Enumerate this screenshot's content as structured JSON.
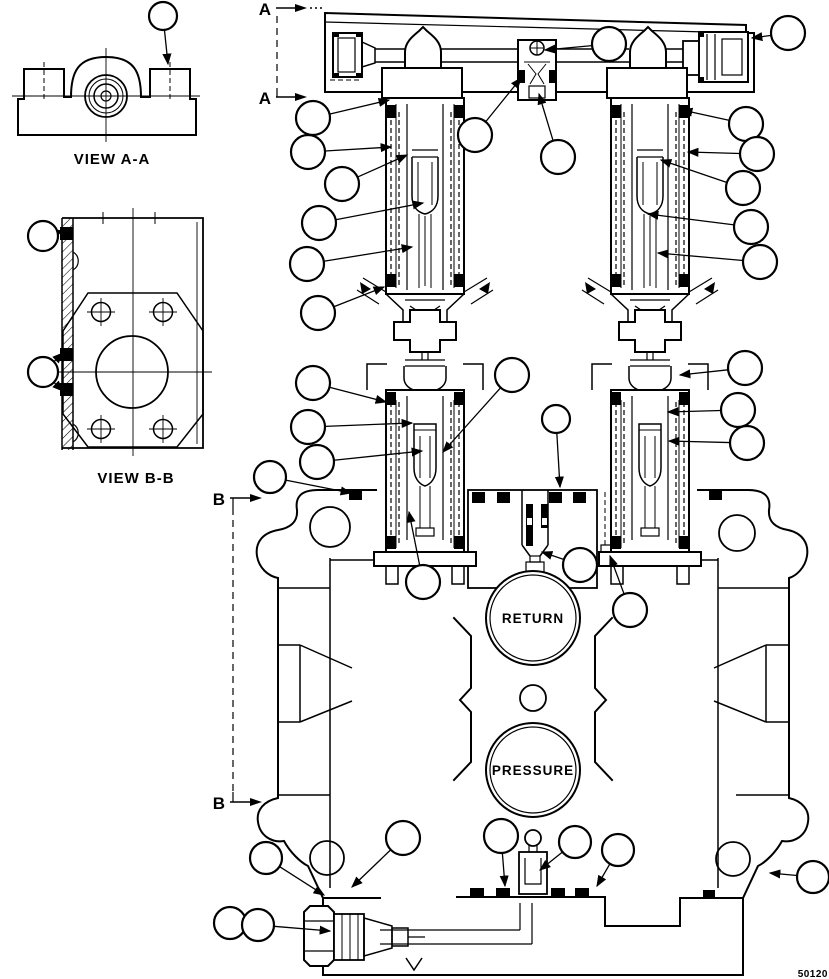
{
  "drawing": {
    "labels": {
      "view_aa": "VIEW A-A",
      "view_bb": "VIEW B-B",
      "figure_code": "50120"
    },
    "ports": {
      "return": "RETURN",
      "pressure": "PRESSURE"
    },
    "section_markers": {
      "a_top": "A",
      "a_bottom": "A",
      "b_top": "B",
      "b_bottom": "B"
    },
    "callouts": [
      {
        "x": 163,
        "y": 16,
        "r": 14,
        "to": [
          [
            168,
            64
          ]
        ]
      },
      {
        "x": 609,
        "y": 44,
        "r": 17,
        "to": [
          [
            545,
            50
          ]
        ]
      },
      {
        "x": 788,
        "y": 33,
        "r": 17,
        "to": [
          [
            752,
            38
          ]
        ]
      },
      {
        "x": 475,
        "y": 135,
        "r": 17,
        "to": [
          [
            521,
            78
          ]
        ]
      },
      {
        "x": 558,
        "y": 157,
        "r": 17,
        "to": [
          [
            539,
            94
          ]
        ]
      },
      {
        "x": 313,
        "y": 118,
        "r": 17,
        "to": [
          [
            389,
            100
          ]
        ]
      },
      {
        "x": 308,
        "y": 152,
        "r": 17,
        "to": [
          [
            391,
            147
          ]
        ]
      },
      {
        "x": 342,
        "y": 184,
        "r": 17,
        "to": [
          [
            407,
            155
          ]
        ]
      },
      {
        "x": 319,
        "y": 223,
        "r": 17,
        "to": [
          [
            423,
            203
          ]
        ]
      },
      {
        "x": 307,
        "y": 264,
        "r": 17,
        "to": [
          [
            412,
            247
          ]
        ]
      },
      {
        "x": 318,
        "y": 313,
        "r": 17,
        "to": [
          [
            384,
            287
          ]
        ]
      },
      {
        "x": 746,
        "y": 124,
        "r": 17,
        "to": [
          [
            682,
            110
          ]
        ]
      },
      {
        "x": 757,
        "y": 154,
        "r": 17,
        "to": [
          [
            688,
            152
          ]
        ]
      },
      {
        "x": 743,
        "y": 188,
        "r": 17,
        "to": [
          [
            661,
            160
          ]
        ]
      },
      {
        "x": 751,
        "y": 227,
        "r": 17,
        "to": [
          [
            648,
            214
          ]
        ]
      },
      {
        "x": 760,
        "y": 262,
        "r": 17,
        "to": [
          [
            658,
            253
          ]
        ]
      },
      {
        "x": 512,
        "y": 375,
        "r": 17,
        "to": [
          [
            443,
            452
          ]
        ]
      },
      {
        "x": 556,
        "y": 419,
        "r": 14,
        "to": [
          [
            560,
            487
          ]
        ]
      },
      {
        "x": 313,
        "y": 383,
        "r": 17,
        "to": [
          [
            386,
            402
          ]
        ]
      },
      {
        "x": 308,
        "y": 427,
        "r": 17,
        "to": [
          [
            412,
            423
          ]
        ]
      },
      {
        "x": 317,
        "y": 462,
        "r": 17,
        "to": [
          [
            422,
            451
          ]
        ]
      },
      {
        "x": 270,
        "y": 477,
        "r": 16,
        "to": [
          [
            351,
            493
          ]
        ]
      },
      {
        "x": 423,
        "y": 582,
        "r": 17,
        "to": [
          [
            409,
            512
          ]
        ]
      },
      {
        "x": 745,
        "y": 368,
        "r": 17,
        "to": [
          [
            680,
            375
          ]
        ]
      },
      {
        "x": 738,
        "y": 410,
        "r": 17,
        "to": [
          [
            668,
            412
          ]
        ]
      },
      {
        "x": 747,
        "y": 443,
        "r": 17,
        "to": [
          [
            669,
            441
          ]
        ]
      },
      {
        "x": 580,
        "y": 565,
        "r": 17,
        "to": [
          [
            542,
            552
          ]
        ]
      },
      {
        "x": 630,
        "y": 610,
        "r": 17,
        "to": [
          [
            610,
            556
          ]
        ]
      },
      {
        "x": 266,
        "y": 858,
        "r": 16,
        "to": [
          [
            324,
            895
          ]
        ]
      },
      {
        "x": 403,
        "y": 838,
        "r": 17,
        "to": [
          [
            352,
            887
          ]
        ]
      },
      {
        "x": 501,
        "y": 836,
        "r": 17,
        "to": [
          [
            505,
            886
          ]
        ]
      },
      {
        "x": 575,
        "y": 842,
        "r": 16,
        "to": [
          [
            540,
            870
          ]
        ]
      },
      {
        "x": 618,
        "y": 850,
        "r": 16,
        "to": [
          [
            597,
            886
          ]
        ]
      },
      {
        "x": 813,
        "y": 877,
        "r": 16,
        "to": [
          [
            770,
            873
          ]
        ]
      },
      {
        "x": 230,
        "y": 923,
        "r": 16,
        "to": []
      },
      {
        "x": 258,
        "y": 925,
        "r": 16,
        "to": [
          [
            330,
            931
          ]
        ]
      },
      {
        "x": 43,
        "y": 236,
        "r": 15,
        "to": [
          [
            63,
            231
          ]
        ]
      },
      {
        "x": 43,
        "y": 372,
        "r": 15,
        "to": [
          [
            63,
            353
          ],
          [
            63,
            391
          ]
        ]
      }
    ]
  }
}
